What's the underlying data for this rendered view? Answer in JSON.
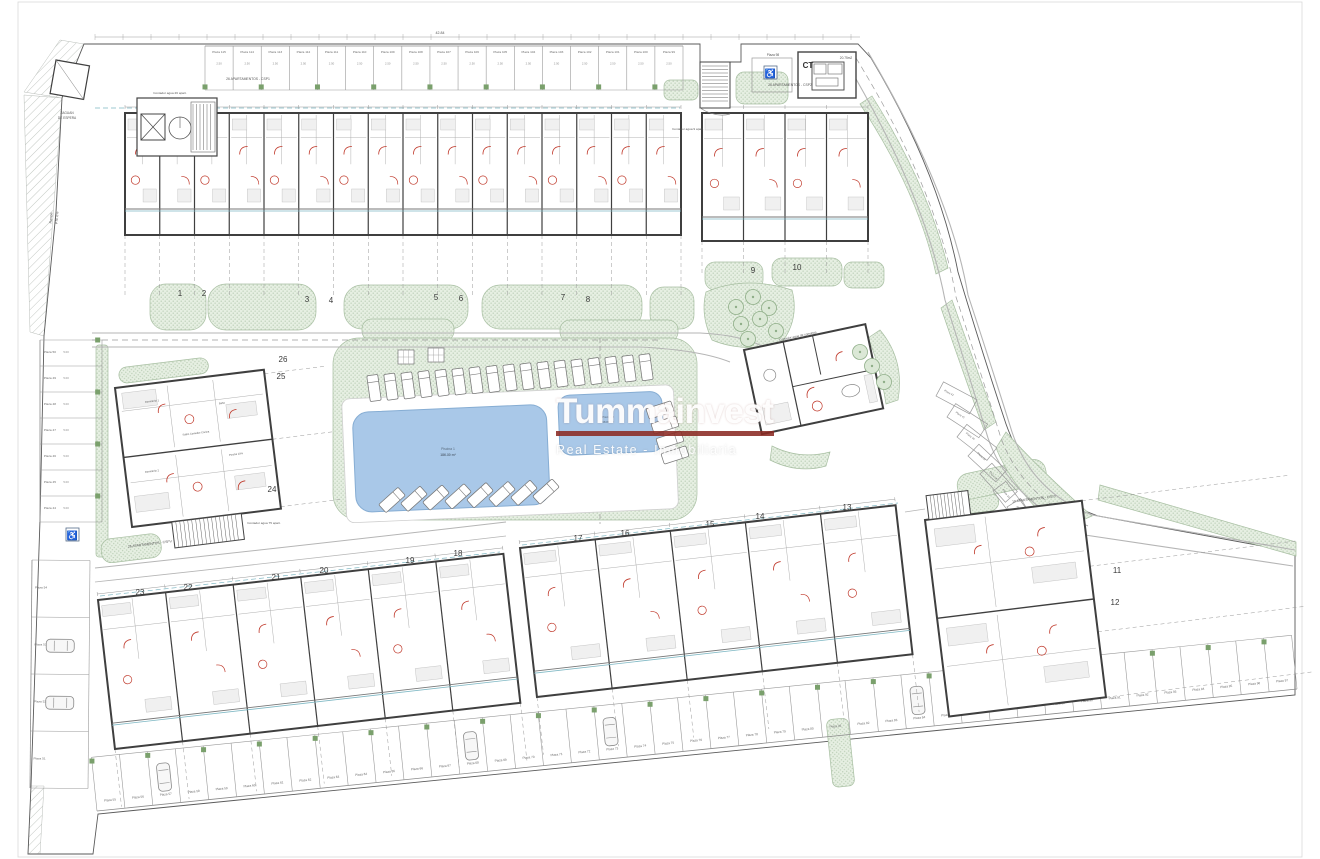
{
  "watermark": {
    "title": "Tummainvest",
    "subtitle": "Real Estate - Inmobiliaria",
    "underline_color": "#8b2a23"
  },
  "colors": {
    "paper": "#ffffff",
    "wall": "#3f3f3f",
    "line": "#9a9a9a",
    "road": "#b5b5b5",
    "green_fill": "#e6efe2",
    "green_dot": "#b9cdb4",
    "green_edge": "#a8bfa2",
    "green_sq": "#7aa06c",
    "pool": "#a9c8e8",
    "pool_edge": "#86add3",
    "red": "#c0392b",
    "teal": "#7fb8c4",
    "text": "#555555",
    "page_border": "#d9d9d9"
  },
  "unit_numbers": [
    {
      "n": "1",
      "x": 180,
      "y": 296
    },
    {
      "n": "2",
      "x": 204,
      "y": 296
    },
    {
      "n": "3",
      "x": 307,
      "y": 302
    },
    {
      "n": "4",
      "x": 331,
      "y": 303
    },
    {
      "n": "5",
      "x": 436,
      "y": 300
    },
    {
      "n": "6",
      "x": 461,
      "y": 301
    },
    {
      "n": "7",
      "x": 563,
      "y": 300
    },
    {
      "n": "8",
      "x": 588,
      "y": 302
    },
    {
      "n": "9",
      "x": 753,
      "y": 273
    },
    {
      "n": "10",
      "x": 797,
      "y": 270
    },
    {
      "n": "11",
      "x": 1117,
      "y": 573
    },
    {
      "n": "12",
      "x": 1115,
      "y": 605
    },
    {
      "n": "13",
      "x": 847,
      "y": 510
    },
    {
      "n": "14",
      "x": 760,
      "y": 519
    },
    {
      "n": "15",
      "x": 710,
      "y": 527
    },
    {
      "n": "16",
      "x": 625,
      "y": 536
    },
    {
      "n": "17",
      "x": 578,
      "y": 541
    },
    {
      "n": "18",
      "x": 458,
      "y": 556
    },
    {
      "n": "19",
      "x": 410,
      "y": 563
    },
    {
      "n": "20",
      "x": 324,
      "y": 573
    },
    {
      "n": "21",
      "x": 276,
      "y": 580
    },
    {
      "n": "22",
      "x": 188,
      "y": 590
    },
    {
      "n": "23",
      "x": 140,
      "y": 595
    },
    {
      "n": "24",
      "x": 272,
      "y": 492
    },
    {
      "n": "25",
      "x": 281,
      "y": 379
    },
    {
      "n": "26",
      "x": 283,
      "y": 362
    }
  ],
  "parking": {
    "stall_width_dim": "2.50",
    "stall_depth_dim": "5.00",
    "top_accessible": "Plaza 98",
    "top_row": [
      "Plaza 115",
      "Plaza 114",
      "Plaza 113",
      "Plaza 112",
      "Plaza 111",
      "Plaza 110",
      "Plaza 109",
      "Plaza 108",
      "Plaza 107",
      "Plaza 106",
      "Plaza 105",
      "Plaza 104",
      "Plaza 103",
      "Plaza 102",
      "Plaza 101",
      "Plaza 100",
      "Plaza 99"
    ],
    "left_column": [
      "Plaza 50",
      "Plaza 49",
      "Plaza 48",
      "Plaza 47",
      "Plaza 46",
      "Plaza 45",
      "Plaza 44"
    ],
    "left_lower": [
      "Plaza 54",
      "Plaza 53",
      "Plaza 52",
      "Plaza 51"
    ],
    "right_curve": [
      "Plaza 42",
      "Plaza 41",
      "Plaza 40",
      "Plaza 39",
      "Plaza 38",
      "Plaza 37",
      "Plaza 36"
    ],
    "bottom_row": [
      "Plaza 55",
      "Plaza 56",
      "Plaza 57",
      "Plaza 58",
      "Plaza 59",
      "Plaza 60",
      "Plaza 61",
      "Plaza 62",
      "Plaza 63",
      "Plaza 64",
      "Plaza 65",
      "Plaza 66",
      "Plaza 67",
      "Plaza 68",
      "Plaza 69",
      "Plaza 70",
      "Plaza 71",
      "Plaza 72",
      "Plaza 73",
      "Plaza 74",
      "Plaza 75",
      "Plaza 76",
      "Plaza 77",
      "Plaza 78",
      "Plaza 79",
      "Plaza 80",
      "Plaza 81",
      "Plaza 82",
      "Plaza 83",
      "Plaza 84",
      "Plaza 85",
      "Plaza 86",
      "Plaza 87",
      "Plaza 88",
      "Plaza 89",
      "Plaza 90",
      "Plaza 91",
      "Plaza 92",
      "Plaza 93",
      "Plaza 94",
      "Plaza 95",
      "Plaza 96",
      "Plaza 97"
    ]
  },
  "annotations": [
    {
      "t": "ZAGUAN",
      "x": 67,
      "y": 114,
      "s": 3.2
    },
    {
      "t": "DE ESPERA",
      "x": 67,
      "y": 119,
      "s": 3.2
    },
    {
      "t": "Rampa",
      "x": 52,
      "y": 218,
      "s": 3.4,
      "r": -85
    },
    {
      "t": "PTE 6%",
      "x": 58,
      "y": 218,
      "s": 3.4,
      "r": -85
    },
    {
      "t": "Contador agua 26 apart.",
      "x": 170,
      "y": 94,
      "s": 3.1
    },
    {
      "t": "26 APARTAMENTOS - CSP1",
      "x": 248,
      "y": 80,
      "s": 3.4
    },
    {
      "t": "Contador agua 9 apart.",
      "x": 688,
      "y": 130,
      "s": 3.1
    },
    {
      "t": "26 APARTAMENTOS - CSP2",
      "x": 790,
      "y": 86,
      "s": 3.4
    },
    {
      "t": "Plaza 98",
      "x": 773,
      "y": 56,
      "s": 3.2
    },
    {
      "t": "CT",
      "x": 808,
      "y": 68,
      "s": 8,
      "b": true,
      "c": "#333333"
    },
    {
      "t": "20.75m2",
      "x": 846,
      "y": 59,
      "s": 3.2
    },
    {
      "t": "Contador agua de comunes",
      "x": 798,
      "y": 337,
      "s": 3.1,
      "r": -12
    },
    {
      "t": "Contador agua 75 apart.",
      "x": 264,
      "y": 524,
      "s": 3.1
    },
    {
      "t": "26 APARTAMENTOS - CSPV",
      "x": 150,
      "y": 545,
      "s": 3.4,
      "r": -7
    },
    {
      "t": "10 APARTAMENTOS - CSP3",
      "x": 1034,
      "y": 500,
      "s": 3.4,
      "r": -7
    },
    {
      "t": "Piscina 1",
      "x": 448,
      "y": 450,
      "s": 3.4,
      "c": "#5a6b7d"
    },
    {
      "t": "186.30 m²",
      "x": 448,
      "y": 456,
      "s": 3.4,
      "c": "#5a6b7d",
      "b": true
    },
    {
      "t": "Piscina 2",
      "x": 608,
      "y": 418,
      "s": 2.9,
      "c": "#5a6b7d"
    },
    {
      "t": "38.80 m²",
      "x": 608,
      "y": 423,
      "s": 2.9,
      "c": "#5a6b7d"
    },
    {
      "t": "42.84",
      "x": 440,
      "y": 34,
      "s": 3.6
    },
    {
      "t": "Salón Comedor Cocina",
      "x": 196,
      "y": 434,
      "s": 2.6,
      "r": -7
    },
    {
      "t": "Dormitorio 1",
      "x": 152,
      "y": 402,
      "s": 2.6,
      "r": -7
    },
    {
      "t": "Dormitorio 2",
      "x": 152,
      "y": 472,
      "s": 2.6,
      "r": -7
    },
    {
      "t": "Baño",
      "x": 222,
      "y": 404,
      "s": 2.6,
      "r": -7
    },
    {
      "t": "Porche 10%",
      "x": 236,
      "y": 455,
      "s": 2.6,
      "r": -7
    }
  ],
  "plan": {
    "boundary": "M62,98 L84,44 L700,44 L700,62 L741,62 L741,44 L858,44 L871,58 Q938,170 958,272 Q982,352 1006,424 Q1030,492 1098,516 L1295,552 L1295,695 L1002,724 L98,814 L93,854 L28,854 L31,786 L40,520 L44,336 L56,212 Z",
    "hatch_paths": [
      "M24,92 L60,40 L84,44 L62,98 Z",
      "M24,95 L62,98 L44,336 L30,332 Z",
      "M28,854 L31,786 L44,786 L40,854 Z"
    ],
    "green_rects": [
      [
        150,
        284,
        56,
        46,
        16,
        0
      ],
      [
        208,
        284,
        108,
        46,
        18,
        0
      ],
      [
        344,
        285,
        124,
        44,
        18,
        0
      ],
      [
        482,
        285,
        160,
        44,
        18,
        0
      ],
      [
        650,
        287,
        44,
        42,
        14,
        0
      ],
      [
        362,
        319,
        92,
        22,
        10,
        0
      ],
      [
        560,
        320,
        118,
        22,
        10,
        0
      ],
      [
        333,
        338,
        364,
        182,
        26,
        0
      ],
      [
        118,
        612,
        70,
        22,
        10,
        -6.5
      ],
      [
        200,
        600,
        92,
        22,
        10,
        -6.5
      ],
      [
        305,
        588,
        98,
        22,
        10,
        -6.5
      ],
      [
        415,
        575,
        72,
        22,
        10,
        -6.5
      ],
      [
        530,
        560,
        78,
        20,
        10,
        -6.5
      ],
      [
        622,
        549,
        92,
        20,
        10,
        -6.5
      ],
      [
        722,
        538,
        92,
        20,
        10,
        -6.5
      ],
      [
        820,
        528,
        58,
        20,
        10,
        -6.5
      ],
      [
        932,
        500,
        66,
        18,
        9,
        -7
      ],
      [
        736,
        72,
        52,
        32,
        8,
        0
      ],
      [
        664,
        80,
        34,
        20,
        6,
        0
      ],
      [
        705,
        262,
        58,
        28,
        10,
        0
      ],
      [
        772,
        258,
        70,
        28,
        10,
        0
      ],
      [
        844,
        262,
        40,
        26,
        8,
        0
      ],
      [
        96,
        345,
        12,
        212,
        3,
        0
      ],
      [
        118,
        368,
        90,
        16,
        8,
        -7
      ],
      [
        100,
        540,
        60,
        24,
        10,
        -7
      ],
      [
        826,
        720,
        22,
        68,
        6,
        -6
      ],
      [
        955,
        476,
        90,
        26,
        12,
        -12
      ]
    ],
    "green_paths": [
      "M872,96 Q928,185 948,268 L936,274 Q918,192 860,104 Z",
      "M952,300 Q974,362 996,422 L984,430 Q962,370 941,308 Z",
      "M1100,485 L1296,542 L1296,556 L1098,500 Z",
      "M706,292 Q745,275 792,290 Q800,320 780,345 Q740,352 712,340 Q700,315 706,292 Z",
      "M880,330 Q905,360 898,400 L886,404 Q880,365 868,338 Z",
      "M772,446 Q800,460 830,452 L826,466 Q798,474 770,460 Z",
      "M1006,432 Q1040,470 1092,516 L1060,530 Q1014,492 996,448 Z"
    ],
    "roads": [
      {
        "d": "M92,333 H700 Q740,335 762,346",
        "w": 1,
        "dash": ""
      },
      {
        "d": "M92,347 H640 Q700,350 730,362",
        "w": 1,
        "dash": ""
      },
      {
        "d": "M92,340 H660",
        "w": 0.7,
        "dash": "6,4"
      },
      {
        "d": "M868,52 Q950,190 968,295 Q992,368 1012,432 Q1032,492 1092,515 L1295,550",
        "w": 1.1,
        "dash": ""
      },
      {
        "d": "M845,60 Q925,195 945,300 Q968,372 988,438 Q1008,498 1085,535 L1293,566",
        "w": 1.1,
        "dash": ""
      },
      {
        "d": "M856,58 Q938,192 956,297 Q980,370 1000,435 Q1020,495 1088,526",
        "w": 0.7,
        "dash": "6,4"
      },
      {
        "d": "M95,568 Q300,546 506,522",
        "w": 1,
        "dash": ""
      },
      {
        "d": "M95,582 Q300,560 506,536",
        "w": 0.8,
        "dash": ""
      },
      {
        "d": "M600,338 V524",
        "w": 0.7,
        "dash": "5,3"
      },
      {
        "d": "M905,512 L925,509",
        "w": 0.8,
        "dash": ""
      }
    ],
    "teal_lines": [
      {
        "x1": 95,
        "y1": 108,
        "x2": 680,
        "y2": 108
      },
      {
        "x1": 100,
        "y1": 596,
        "x2": 500,
        "y2": 552
      },
      {
        "x1": 522,
        "y1": 545,
        "x2": 898,
        "y2": 503
      }
    ],
    "buildings": [
      {
        "id": "north-main",
        "x": 125,
        "y": 113,
        "w": 556,
        "h": 122,
        "rot": 0,
        "units": 16,
        "porch": 26,
        "garden": 62
      },
      {
        "id": "north-east",
        "x": 702,
        "y": 113,
        "w": 166,
        "h": 128,
        "rot": 0,
        "units": 4,
        "porch": 24,
        "garden": 34
      },
      {
        "id": "south-west",
        "x": 98,
        "y": 600,
        "w": 408,
        "h": 150,
        "rot": -6.5,
        "units": 6,
        "porch": 26,
        "garden": 58
      },
      {
        "id": "south-mid",
        "x": 520,
        "y": 548,
        "w": 378,
        "h": 150,
        "rot": -6.5,
        "units": 5,
        "porch": 26,
        "garden": 58
      }
    ],
    "west_block": {
      "x": 115,
      "y": 388,
      "w": 150,
      "h": 140,
      "rot": -7
    },
    "se_block": {
      "x": 925,
      "y": 520,
      "w": 158,
      "h": 198,
      "rot": -7,
      "garden_len": 210
    },
    "club": {
      "x": 744,
      "y": 350,
      "w": 124,
      "h": 86,
      "rot": -12
    },
    "pool": {
      "rot": -2.5,
      "cx": 505,
      "cy": 452,
      "deck": {
        "x": 344,
        "y": 392,
        "w": 332,
        "h": 124
      },
      "p1": {
        "x": 354,
        "y": 406,
        "w": 194,
        "h": 100,
        "r": 16
      },
      "p2": {
        "x": 560,
        "y": 398,
        "w": 104,
        "h": 60,
        "r": 12
      }
    },
    "sunbeds": [
      {
        "x0": 374,
        "y0": 388,
        "dx": 17,
        "dy": -1.3,
        "n": 17,
        "rot": -8
      },
      {
        "x0": 392,
        "y0": 500,
        "dx": 22,
        "dy": -1.2,
        "n": 8,
        "rot": 48
      },
      {
        "x0": 660,
        "y0": 410,
        "dx": 5,
        "dy": 15,
        "n": 4,
        "rot": 72
      }
    ],
    "tables": [
      {
        "x": 398,
        "y": 350
      },
      {
        "x": 428,
        "y": 348
      }
    ],
    "trees": [
      [
        736,
        307
      ],
      [
        753,
        297
      ],
      [
        769,
        308
      ],
      [
        741,
        324
      ],
      [
        760,
        319
      ],
      [
        776,
        331
      ],
      [
        748,
        339
      ],
      [
        860,
        352
      ],
      [
        872,
        366
      ],
      [
        884,
        382
      ]
    ],
    "rows": {
      "top": {
        "x1": 205,
        "y1": 46,
        "x2": 683,
        "y2": 46,
        "depth": 44,
        "flip": false,
        "labels_key": "top_row",
        "dim": "2.50",
        "lrot": 0,
        "squares": true
      },
      "left": {
        "x1": 40,
        "y1": 340,
        "x2": 40,
        "y2": 522,
        "depth": 62,
        "flip": true,
        "labels_key": "left_column",
        "dim": "5.00",
        "lrot": 0,
        "squares": true
      },
      "lower": {
        "x1": 32,
        "y1": 560,
        "x2": 30,
        "y2": 788,
        "depth": 58,
        "flip": true,
        "labels_key": "left_lower",
        "lrot": 0,
        "cars": [
          1,
          2
        ]
      },
      "bottom": {
        "x1": 97,
        "y1": 811,
        "x2": 1297,
        "y2": 689,
        "depth": 54,
        "flip": true,
        "labels_key": "bottom_row",
        "squares": true,
        "cars": [
          2,
          13,
          18,
          29,
          32
        ]
      }
    },
    "right_stalls": [
      {
        "x": 936,
        "y": 396,
        "r": -62
      },
      {
        "x": 947,
        "y": 417,
        "r": -57
      },
      {
        "x": 957,
        "y": 437,
        "r": -52
      },
      {
        "x": 968,
        "y": 456,
        "r": -47
      },
      {
        "x": 980,
        "y": 474,
        "r": -42
      },
      {
        "x": 993,
        "y": 491,
        "r": -37
      },
      {
        "x": 1007,
        "y": 507,
        "r": -32
      }
    ]
  }
}
